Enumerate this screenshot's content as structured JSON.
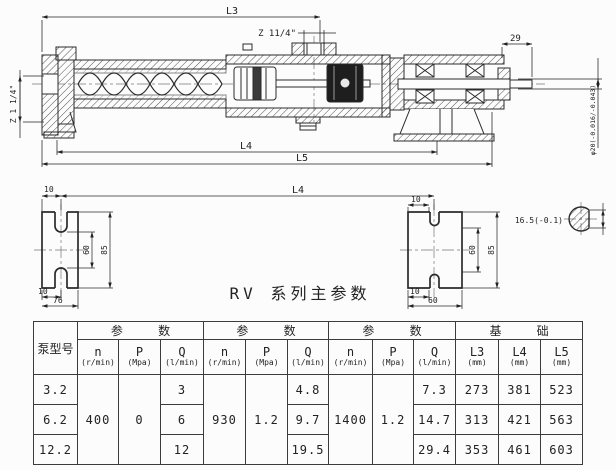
{
  "title": "RV 系列主参数",
  "drawing": {
    "dims": {
      "l3": "L3",
      "l4": "L4",
      "l5": "L5",
      "l4_views": "L4",
      "port_top": "Z 11/4\"",
      "port_left": "Z 1 1/4\"",
      "shaft_len": "29",
      "shaft_dia": "φ20(-0.016/-0.043)",
      "key_section": "16.5(-0.1)"
    },
    "left_view": {
      "top": "10",
      "side_inner": "60",
      "side_outer": "85",
      "bottom_a": "10",
      "bottom_b": "76"
    },
    "right_view": {
      "top": "10",
      "side_inner": "60",
      "side_outer": "85",
      "bottom_a": "10",
      "bottom_b": "60"
    }
  },
  "table": {
    "model_header": "泵型号",
    "group_param": "参 数",
    "group_base": "基 础",
    "sub": {
      "n": "n",
      "n_unit": "(r/min)",
      "p": "P",
      "p_unit": "(Mpa)",
      "q": "Q",
      "q_unit": "(l/min)",
      "l3": "L3",
      "l4": "L4",
      "l5": "L5",
      "mm_unit": "(mm)"
    },
    "merged": {
      "n1": "400",
      "p1": "0",
      "n2": "930",
      "p2": "1.2",
      "n3": "1400",
      "p3": "1.2"
    },
    "rows": [
      {
        "model": "3.2",
        "q1": "3",
        "q2": "4.8",
        "q3": "7.3",
        "l3": "273",
        "l4": "381",
        "l5": "523"
      },
      {
        "model": "6.2",
        "q1": "6",
        "q2": "9.7",
        "q3": "14.7",
        "l3": "313",
        "l4": "421",
        "l5": "563"
      },
      {
        "model": "12.2",
        "q1": "12",
        "q2": "19.5",
        "q3": "29.4",
        "l3": "353",
        "l4": "461",
        "l5": "603"
      }
    ]
  }
}
